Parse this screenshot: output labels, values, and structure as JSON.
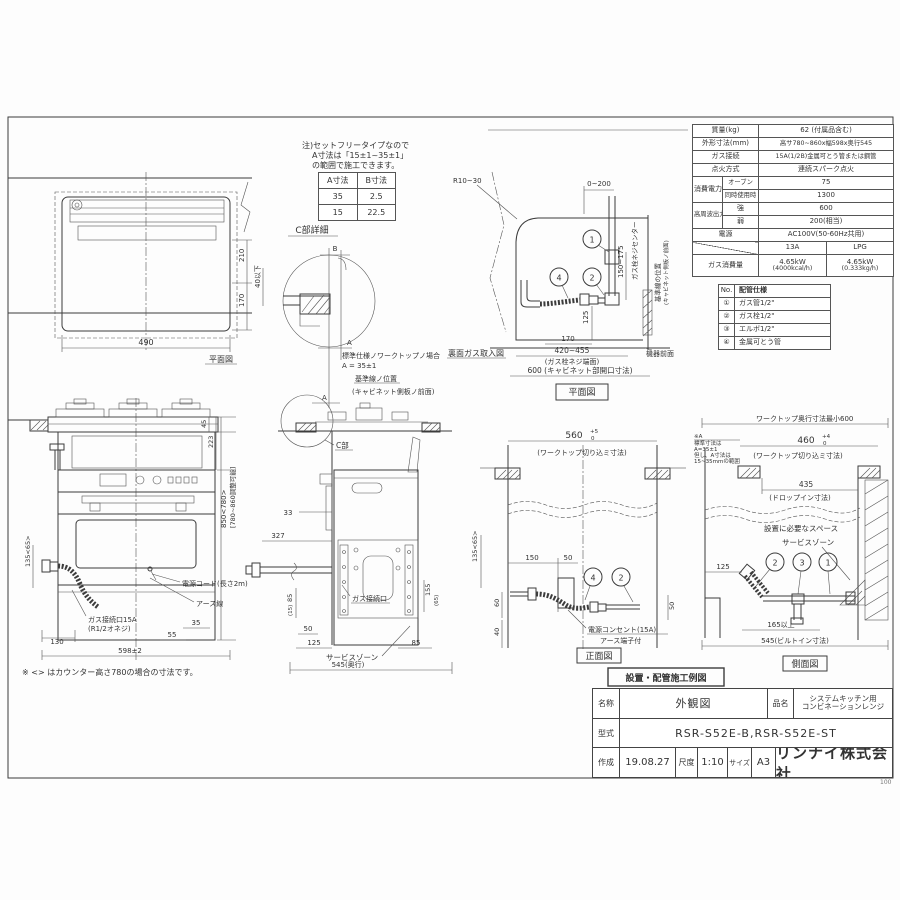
{
  "notes": {
    "l1": "注)セットフリータイプなので",
    "l2": "A寸法は「15±1~35±1」",
    "l3": "の範囲で施工できます。",
    "counter": "※ <> はカウンター高さ780の場合の寸法です。"
  },
  "ab_table": {
    "h1": "A寸法",
    "h2": "B寸法",
    "r1c1": "35",
    "r1c2": "2.5",
    "r2c1": "15",
    "r2c2": "22.5"
  },
  "spec": {
    "mass_l": "質量(kg)",
    "mass_v": "62 (付属品含む)",
    "dim_l": "外形寸法(mm)",
    "dim_v": "高サ780~860x幅598x奥行545",
    "gas_l": "ガス接続",
    "gas_v": "15A(1/2B)金属可とう管または鋼管",
    "ign_l": "点火方式",
    "ign_v": "連続スパーク点火",
    "pow_l": "消費電力(W)",
    "pow1_l": "オーブン",
    "pow1_v": "75",
    "pow2_l": "同時使用時",
    "pow2_v": "1300",
    "hf_l": "高周波出力(W)",
    "hf1_l": "強",
    "hf1_v": "600",
    "hf2_l": "弱",
    "hf2_v": "200(相当)",
    "src_l": "電源",
    "src_v": "AC100V(50-60Hz共用)",
    "col_13a": "13A",
    "col_lpg": "LPG",
    "use_l": "ガス消費量",
    "use_13a": "4.65kW",
    "use_13a2": "(4000kcal/h)",
    "use_lpg": "4.65kW",
    "use_lpg2": "(0.333kg/h)"
  },
  "piping": {
    "no_h": "No.",
    "title": "配管仕様",
    "rows": [
      {
        "no": "①",
        "label": "ガス管1/2\""
      },
      {
        "no": "②",
        "label": "ガス栓1/2\""
      },
      {
        "no": "③",
        "label": "エルボ1/2\""
      },
      {
        "no": "④",
        "label": "金属可とう管"
      }
    ]
  },
  "plan_left": {
    "title": "平面図",
    "d490": "490",
    "d210": "210",
    "d170": "170"
  },
  "c_detail": {
    "title": "C部詳細",
    "b": "B",
    "a": "A",
    "a2": "A",
    "d40": "40以下",
    "std1": "標準仕様ノワークトップノ場合",
    "std2": "A = 35±1",
    "ref1": "基準線ノ位置",
    "ref2": "(キャビネット側板ノ前面)"
  },
  "rear": {
    "title": "裏面ガス取入図",
    "plan": "平面図",
    "r": "R10~30",
    "d0200": "0~200",
    "d150": "150~175",
    "center": "ガス栓ネジセンター",
    "ref": "基準線の位置",
    "ref2": "(キャビネット側板ノ前面)",
    "front": "機器前面",
    "d125": "125",
    "d170": "170",
    "d420": "420~455",
    "d420n": "(ガス栓ネジ端面)",
    "d600": "600 (キャビネット部開口寸法)",
    "n1": "1",
    "n2": "2",
    "n4": "4"
  },
  "front": {
    "d45": "45",
    "d223": "223",
    "d850": "850<780>",
    "d850n": "[780~860調整可能]",
    "d135": "135<65>",
    "cord": "電源コード(長さ2m)",
    "earth": "アース線",
    "gas1": "ガス接続口15A",
    "gas2": "(R1/2オネジ)",
    "d130": "130",
    "d55": "55",
    "d35": "35",
    "d598": "598±2"
  },
  "side": {
    "c": "C部",
    "d33": "33",
    "d327": "327",
    "gas": "ガス接続口",
    "d85l": "85",
    "d15": "(15)",
    "d50": "50",
    "d125": "125",
    "d155": "155",
    "d65": "(65)",
    "d85r": "85",
    "service": "サービスゾーン",
    "d545": "545(奥行)"
  },
  "ifront": {
    "title": "正面図",
    "d560": "560",
    "tol_t": "+5",
    "tol_b": "0",
    "cut": "(ワークトップ切り込ミ寸法)",
    "d135": "135<65>",
    "d150": "150",
    "d50a": "50",
    "d60": "60",
    "d40": "40",
    "d50b": "50",
    "outlet": "電源コンセント(15A)",
    "earth": "アース端子付",
    "n4": "4",
    "n2": "2"
  },
  "iside": {
    "title": "側面図",
    "top": "ワークトップ奥行寸法最小600",
    "d460": "460",
    "tol_t": "+4",
    "tol_b": "0",
    "cut": "(ワークトップ切り込ミ寸法)",
    "na1": "※A",
    "na2": "標準寸法は",
    "na3": "A=35±1",
    "na4": "但し、A寸法は",
    "na5": "15~35mmの範囲",
    "d435": "435",
    "drop": "(ドロップイン寸法)",
    "space": "設置に必要なスペース",
    "service": "サービスゾーン",
    "d125": "125",
    "d165": "165以上",
    "d545": "545(ビルトイン寸法)",
    "n1": "1",
    "n2": "2",
    "n3": "3"
  },
  "install_label": "設置・配管施工例図",
  "title_block": {
    "name_l": "名称",
    "name": "外観図",
    "item_l": "品名",
    "item1": "システムキッチン用",
    "item2": "コンビネーションレンジ",
    "model_l": "型式",
    "model": "RSR-S52E-B,RSR-S52E-ST",
    "date_l": "作成",
    "date": "19.08.27",
    "scale_l": "尺度",
    "scale": "1:10",
    "size_l": "サイズ",
    "size": "A3",
    "company": "リンナイ株式会社",
    "sheet": "100"
  }
}
